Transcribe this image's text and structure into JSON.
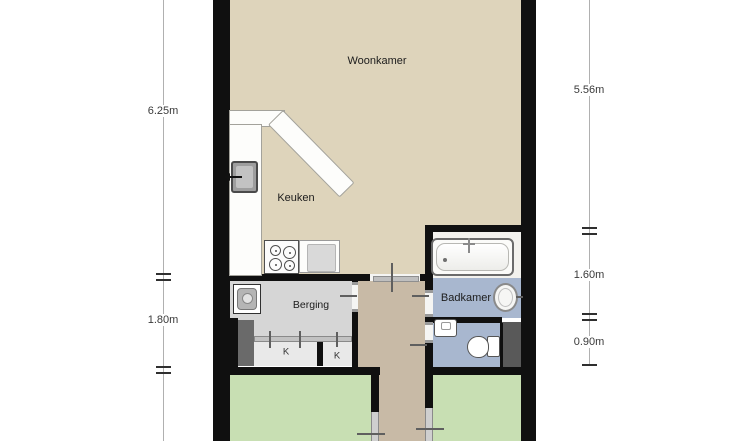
{
  "floorplan": {
    "title": "apartment-floorplan",
    "rooms": [
      {
        "name": "woonkamer",
        "label": "Woonkamer"
      },
      {
        "name": "keuken",
        "label": "Keuken"
      },
      {
        "name": "berging",
        "label": "Berging"
      },
      {
        "name": "badkamer",
        "label": "Badkamer"
      },
      {
        "name": "closet-1",
        "label": "K"
      },
      {
        "name": "closet-2",
        "label": "K"
      }
    ],
    "dimensions": {
      "left": [
        {
          "value": "6.25m"
        },
        {
          "value": "1.80m"
        }
      ],
      "right": [
        {
          "value": "5.56m"
        },
        {
          "value": "1.60m"
        },
        {
          "value": "0.90m"
        }
      ]
    },
    "fixtures": [
      "kitchen-counter",
      "oven-icon",
      "stove-icon",
      "sink-icon",
      "washing-machine-icon",
      "bathtub-icon",
      "washbasin-icon",
      "hand-basin-icon",
      "toilet-icon",
      "closet-sliding-door",
      "shaft"
    ],
    "colors": {
      "wall": "#101010",
      "woonkamer_floor": "#ded4bb",
      "hall_floor": "#c8baa6",
      "berging_floor": "#d6d6d6",
      "bathroom_floor": "#a8b7cf",
      "bedroom_floor": "#c8dfb3",
      "closet_floor": "#e9e9e9",
      "shaft_gray": "#595959",
      "dimension_text": "#3a3a3a"
    }
  }
}
